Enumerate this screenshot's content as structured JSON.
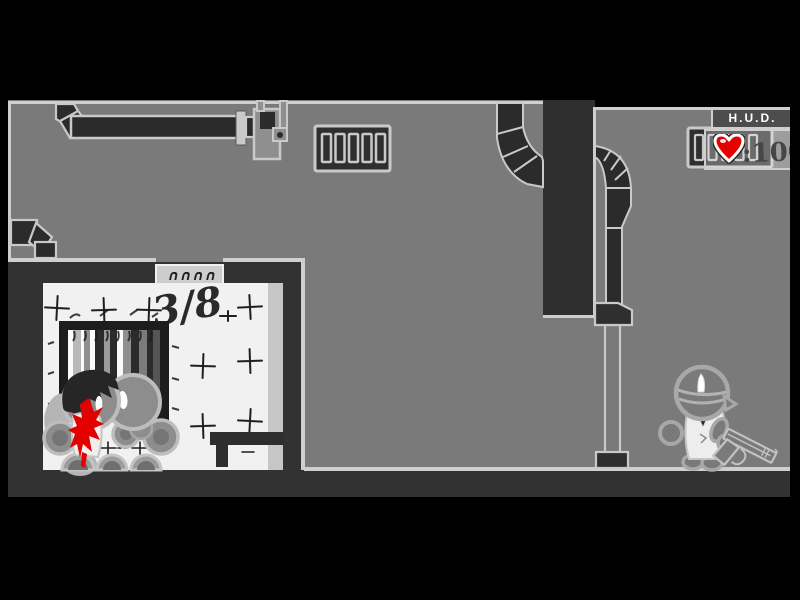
{
  "stage": {
    "description": "flash-game-viewport"
  },
  "hud": {
    "title": "H.U.D.",
    "health_separator": ":",
    "health_value": "100",
    "heart_icon": "heart-icon",
    "heart_color": "#e60000"
  },
  "scene": {
    "graffiti_text": "3/8",
    "door_sign_glyphs": "∩∩∩∩",
    "entities": {
      "hostage": "blindfolded-figure-with-pistol",
      "casualties": "body-pile-with-blood"
    },
    "colors": {
      "background_gray": "#7a7a7a",
      "wall_dark": "#323232",
      "duct_dark": "#2b2b2b",
      "outline_light": "#cfcfcf",
      "room_white": "#f1f1f1",
      "blood_red": "#e30000",
      "health_text": "#464646",
      "hud_title_bg": "#4d4d4d"
    }
  }
}
